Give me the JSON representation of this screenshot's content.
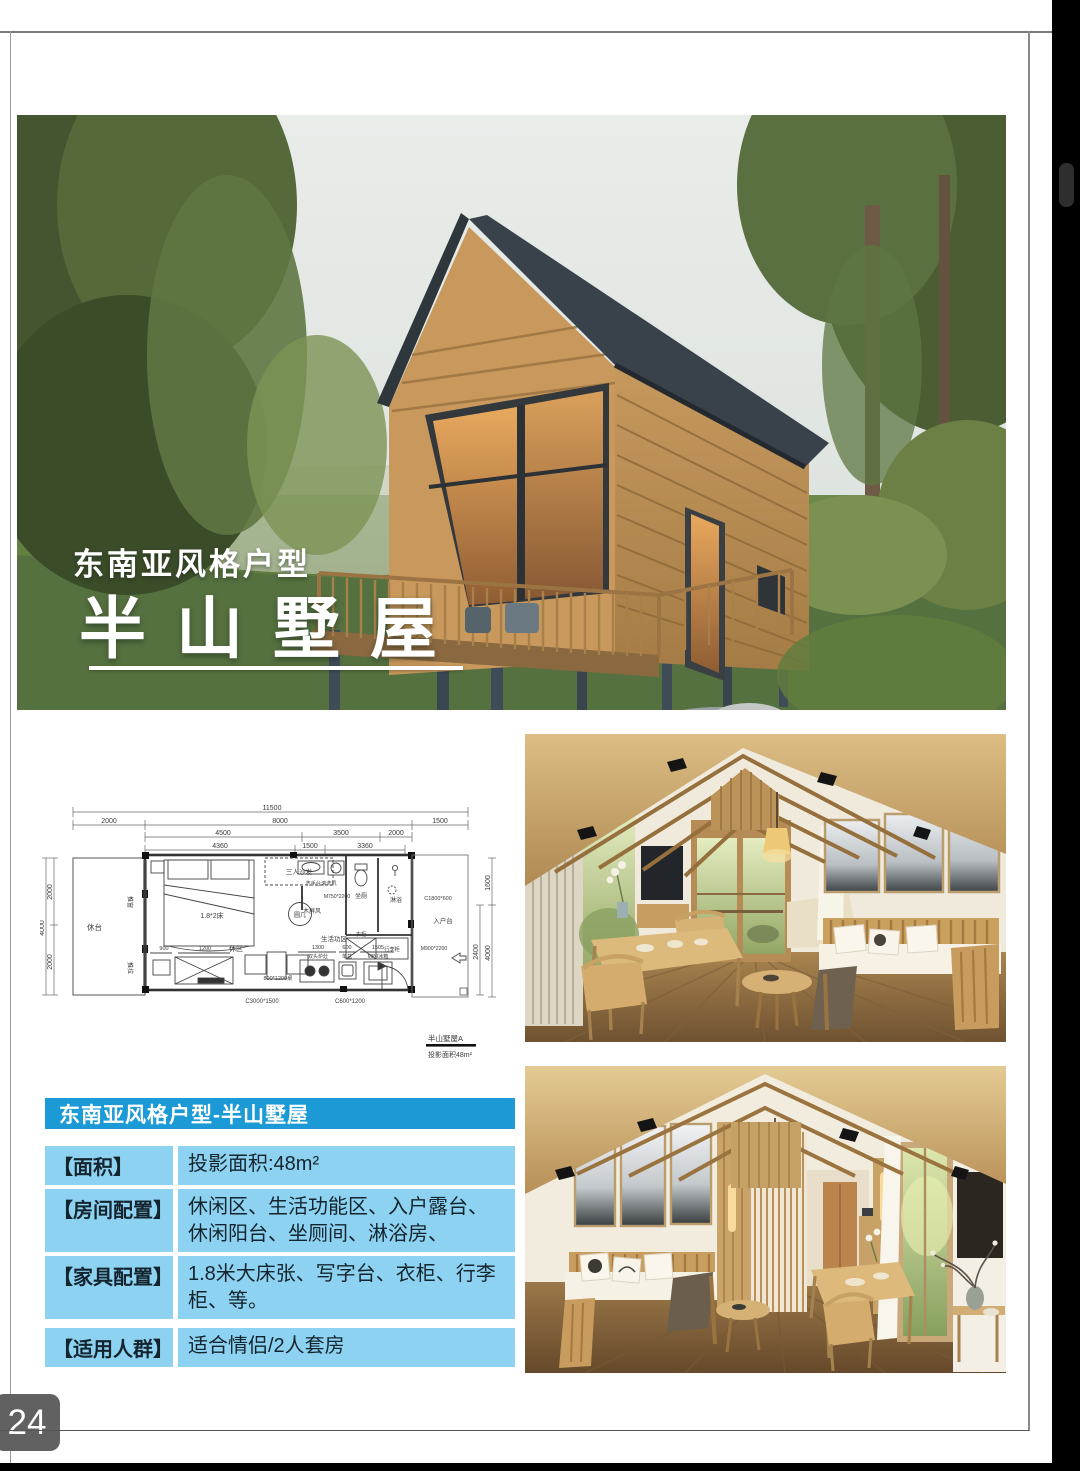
{
  "page": {
    "number": "24"
  },
  "colors": {
    "header_blue": "#1b9ad6",
    "row_blue": "#8dd3f1"
  },
  "hero": {
    "tagline": "东南亚风格户型",
    "title": "半山墅屋"
  },
  "floorplan": {
    "caption_title": "半山墅屋A",
    "caption_area": "投影面积48m²",
    "labels": {
      "d_total": "11500",
      "d_2000a": "2000",
      "d_8000": "8000",
      "d_1500a": "1500",
      "d_4500": "4500",
      "d_3500": "3500",
      "d_2000b": "2000",
      "d_4360": "4360",
      "d_1500b": "1500",
      "d_3360": "3360",
      "d_2000L1": "2000",
      "d_2000L2": "2000",
      "d_4000L": "4000",
      "d_1600": "1600",
      "d_4000R": "4000",
      "d_2400": "2400",
      "d_900": "900",
      "d_1200": "1200",
      "d_1300": "1300",
      "d_600": "600",
      "d_1505": "1505",
      "terrace": "休台",
      "push_window": "推窗",
      "sliding": "推拉",
      "sofa": "三人沙发",
      "bed": "1.8*2床",
      "round_table": "圆几",
      "rest_area": "休区",
      "living_area": "生活功区",
      "washstand": "洗手台滚洗机",
      "door1": "M750*2200",
      "screen": "木屏风",
      "toilet": "坐厕",
      "shower": "淋浴",
      "window1": "C1800*600",
      "entry": "入户台",
      "wardrobe": "衣柜",
      "luggage": "行李柜",
      "stove": "双头炉灶",
      "sink": "单盆",
      "fridge": "MINI冰箱",
      "door2": "M900*2200",
      "window2": "C600*1200",
      "window3": "C3000*1500",
      "desk_table": "800*1200桌"
    }
  },
  "info_table": {
    "header": "东南亚风格户型-半山墅屋",
    "rows": [
      {
        "label": "【面积】",
        "value": "投影面积:48m²"
      },
      {
        "label": "【房间配置】",
        "value": "休闲区、生活功能区、入户露台、休闲阳台、坐厕间、淋浴房、"
      },
      {
        "label": "【家具配置】",
        "value": "1.8米大床张、写字台、衣柜、行李柜、等。"
      },
      {
        "label": "【适用人群】",
        "value": "适合情侣/2人套房"
      }
    ]
  }
}
